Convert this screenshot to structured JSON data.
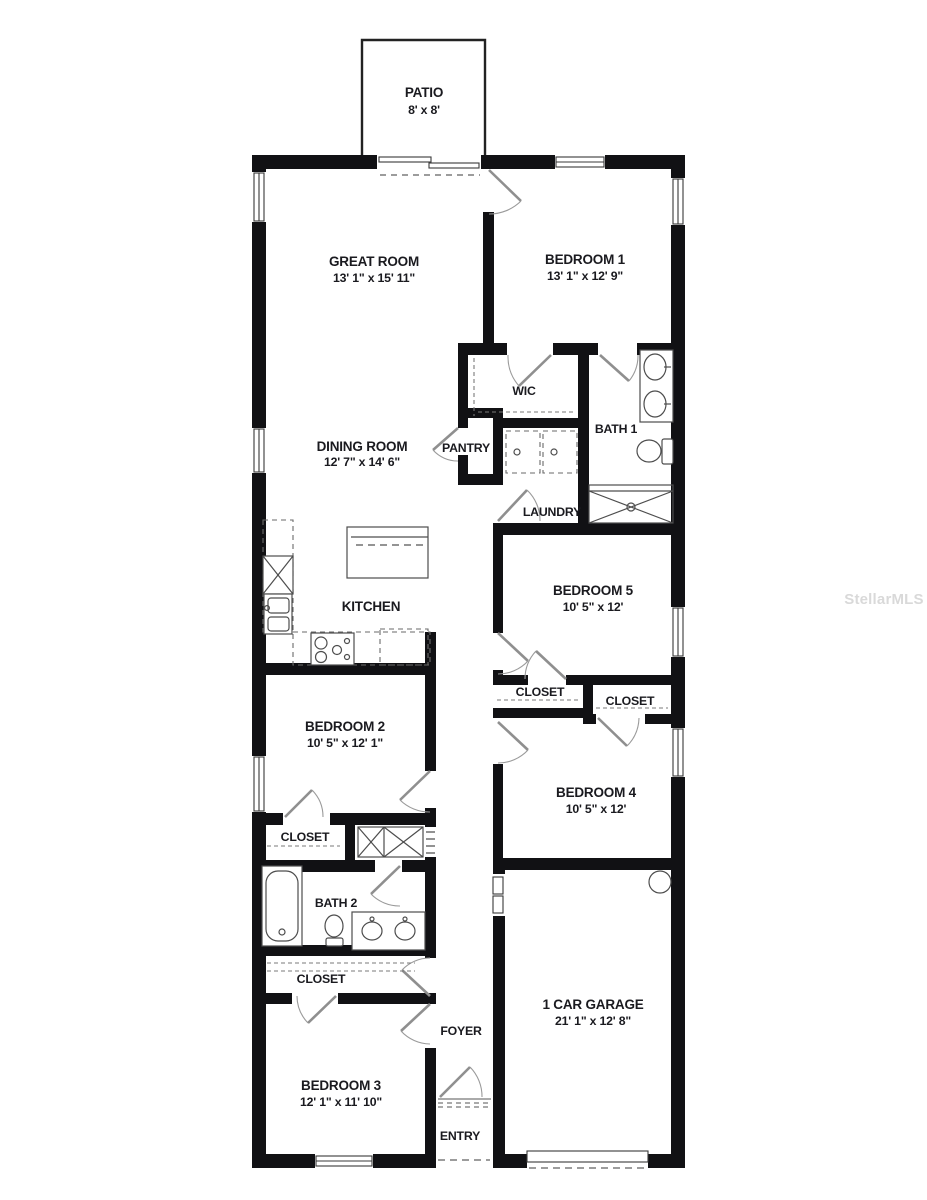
{
  "plan": {
    "watermark": "StellarMLS",
    "rooms": {
      "patio": {
        "name": "PATIO",
        "dims": "8' x 8'"
      },
      "great_room": {
        "name": "GREAT ROOM",
        "dims": "13' 1\" x 15' 11\""
      },
      "bedroom_1": {
        "name": "BEDROOM 1",
        "dims": "13' 1\" x 12' 9\""
      },
      "wic": {
        "name": "WIC"
      },
      "bath_1": {
        "name": "BATH 1"
      },
      "dining_room": {
        "name": "DINING ROOM",
        "dims": "12' 7\" x 14' 6\""
      },
      "pantry": {
        "name": "PANTRY"
      },
      "laundry": {
        "name": "LAUNDRY"
      },
      "kitchen": {
        "name": "KITCHEN"
      },
      "bedroom_5": {
        "name": "BEDROOM 5",
        "dims": "10' 5\" x 12'"
      },
      "closet_bedroom_5": {
        "name": "CLOSET"
      },
      "closet_bedroom_4": {
        "name": "CLOSET"
      },
      "bedroom_2": {
        "name": "BEDROOM 2",
        "dims": "10' 5\" x 12' 1\""
      },
      "bedroom_4": {
        "name": "BEDROOM 4",
        "dims": "10' 5\" x 12'"
      },
      "closet_bedroom_2": {
        "name": "CLOSET"
      },
      "bath_2": {
        "name": "BATH 2"
      },
      "closet_bedroom_3": {
        "name": "CLOSET"
      },
      "bedroom_3": {
        "name": "BEDROOM 3",
        "dims": "12' 1\" x 11' 10\""
      },
      "foyer": {
        "name": "FOYER"
      },
      "garage": {
        "name": "1 CAR GARAGE",
        "dims": "21' 1\" x 12' 8\""
      },
      "entry": {
        "name": "ENTRY"
      }
    }
  }
}
